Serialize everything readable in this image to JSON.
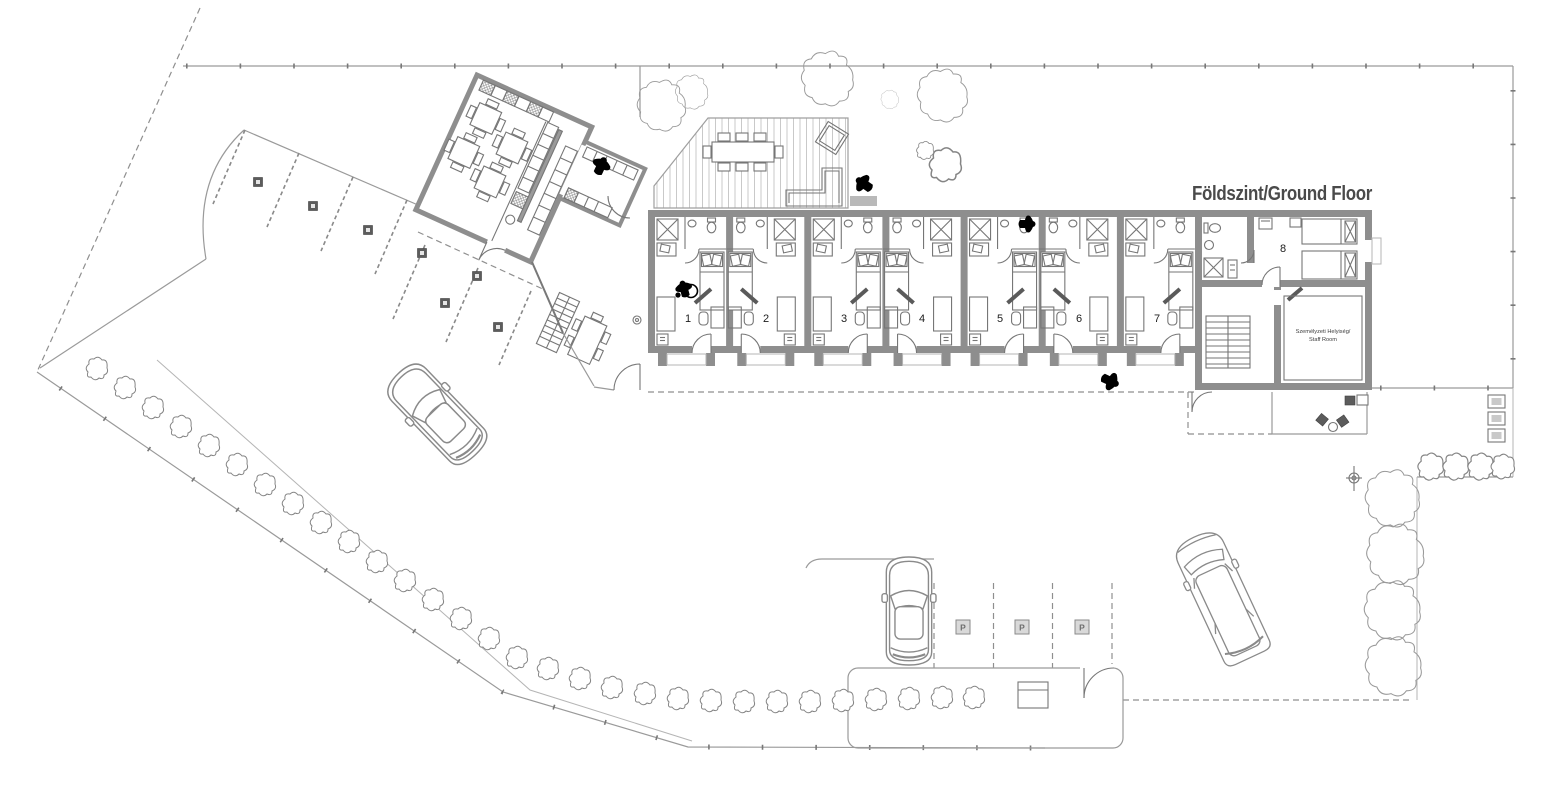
{
  "drawing": {
    "title": "Földszint/Ground Floor",
    "rooms": [
      {
        "number": "1"
      },
      {
        "number": "2"
      },
      {
        "number": "3"
      },
      {
        "number": "4"
      },
      {
        "number": "5"
      },
      {
        "number": "6"
      },
      {
        "number": "7"
      },
      {
        "number": "8"
      }
    ],
    "staff_room": {
      "label_hu": "Személyzeti Helyiség/",
      "label_en": "Staff  Room"
    },
    "parking": {
      "marker": "P"
    },
    "colors": {
      "wall": "#8e8e8e",
      "line": "#787878",
      "text": "#444444",
      "figure": "#000000",
      "bg": "#ffffff"
    }
  }
}
